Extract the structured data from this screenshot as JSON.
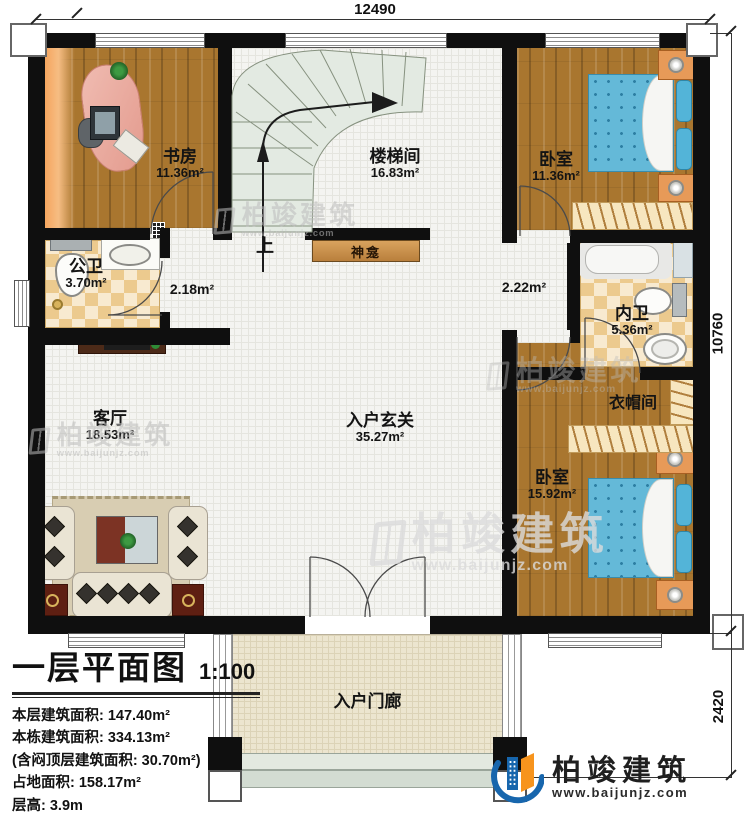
{
  "dimensions": {
    "width_top": "12490",
    "height_right": "10760",
    "porch_height": "2420"
  },
  "rooms": {
    "study": {
      "name": "书房",
      "area": "11.36m²"
    },
    "stairwell": {
      "name": "楼梯间",
      "area": "16.83m²"
    },
    "bedroom_top": {
      "name": "卧室",
      "area": "11.36m²"
    },
    "public_bath": {
      "name": "公卫",
      "area": "3.70m²"
    },
    "hall_left": {
      "area": "2.18m²"
    },
    "hall_right": {
      "area": "2.22m²"
    },
    "private_bath": {
      "name": "内卫",
      "area": "5.36m²"
    },
    "living": {
      "name": "客厅",
      "area": "18.53m²"
    },
    "foyer": {
      "name": "入户玄关",
      "area": "35.27m²"
    },
    "cloakroom": {
      "name": "衣帽间"
    },
    "bedroom_bottom": {
      "name": "卧室",
      "area": "15.92m²"
    },
    "porch": {
      "name": "入户门廊"
    }
  },
  "plan_labels": {
    "up": "上",
    "shrine": "神龛"
  },
  "title_block": {
    "title": "一层平面图",
    "scale": "1:100",
    "lines": [
      "本层建筑面积: 147.40m²",
      "本栋建筑面积: 334.13m²",
      "(含闷顶层建筑面积: 30.70m²)",
      "占地面积: 158.17m²",
      "层高: 3.9m"
    ]
  },
  "branding": {
    "company": "柏竣建筑",
    "website": "www.baijunjz.com"
  },
  "colors": {
    "wall": "#0f0f0f",
    "wood": "#a9762f",
    "bed_blue": "#64b9d8",
    "logo_blue": "#1766ad",
    "logo_orange": "#f7941d"
  }
}
